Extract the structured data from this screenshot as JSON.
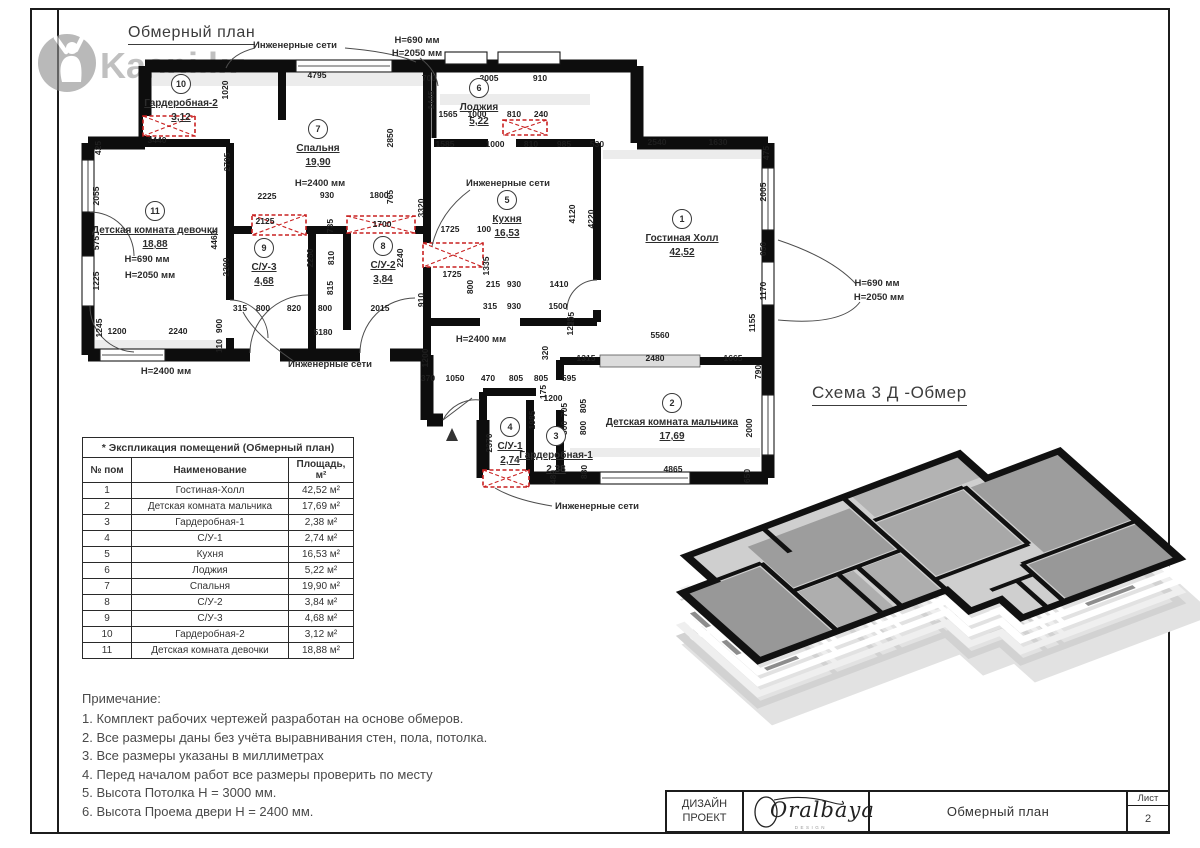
{
  "sheet": {
    "plan_title": "Обмерный план",
    "scheme3d_title": "Схема 3 Д -Обмер",
    "watermark_text": "Kaspi.kz",
    "titleblock": {
      "company_line1": "ДИЗАЙН",
      "company_line2": "ПРОЕКТ",
      "logo_text": "Oralbaya",
      "logo_sub": "DESIGN",
      "doc_title": "Обмерный план",
      "sheet_label": "Лист",
      "sheet_number": "2"
    }
  },
  "explication_table": {
    "title": "* Экспликация помещений (Обмерный план)",
    "headers": [
      "№ пом",
      "Наименование",
      "Площадь, м²"
    ],
    "rows": [
      [
        "1",
        "Гостиная-Холл",
        "42,52 м²"
      ],
      [
        "2",
        "Детская комната мальчика",
        "17,69 м²"
      ],
      [
        "3",
        "Гардеробная-1",
        "2,38 м²"
      ],
      [
        "4",
        "С/У-1",
        "2,74 м²"
      ],
      [
        "5",
        "Кухня",
        "16,53 м²"
      ],
      [
        "6",
        "Лоджия",
        "5,22 м²"
      ],
      [
        "7",
        "Спальня",
        "19,90 м²"
      ],
      [
        "8",
        "С/У-2",
        "3,84 м²"
      ],
      [
        "9",
        "С/У-3",
        "4,68 м²"
      ],
      [
        "10",
        "Гардеробная-2",
        "3,12 м²"
      ],
      [
        "11",
        "Детская комната девочки",
        "18,88 м²"
      ]
    ]
  },
  "notes": {
    "title": "Примечание:",
    "items": [
      "1. Комплект рабочих чертежей разработан на основе обмеров.",
      "2. Все размеры даны без учёта выравнивания стен, пола, потолка.",
      "3. Все размеры указаны в миллиметрах",
      "4. Перед началом работ все размеры проверить по месту",
      "5. Высота Потолка Н = 3000 мм.",
      "6. Высота Проема двери Н = 2400 мм."
    ]
  },
  "plan": {
    "rooms": [
      {
        "num": "1",
        "name": "Гостиная Холл",
        "area": "42,52",
        "x": 682,
        "y": 219
      },
      {
        "num": "2",
        "name": "Детская комната мальчика",
        "area": "17,69",
        "x": 672,
        "y": 403
      },
      {
        "num": "3",
        "name": "Гардеробная-1",
        "area": "2,38",
        "x": 556,
        "y": 436
      },
      {
        "num": "4",
        "name": "С/У-1",
        "area": "2,74",
        "x": 510,
        "y": 427
      },
      {
        "num": "5",
        "name": "Кухня",
        "area": "16,53",
        "x": 507,
        "y": 200
      },
      {
        "num": "6",
        "name": "Лоджия",
        "area": "5,22",
        "x": 479,
        "y": 88
      },
      {
        "num": "7",
        "name": "Спальня",
        "area": "19,90",
        "x": 318,
        "y": 129
      },
      {
        "num": "8",
        "name": "С/У-2",
        "area": "3,84",
        "x": 383,
        "y": 246
      },
      {
        "num": "9",
        "name": "С/У-3",
        "area": "4,68",
        "x": 264,
        "y": 248
      },
      {
        "num": "10",
        "name": "Гардеробная-2",
        "area": "3,12",
        "x": 181,
        "y": 84
      },
      {
        "num": "11",
        "name": "Детская комната девочки",
        "area": "18,88",
        "x": 155,
        "y": 211
      }
    ],
    "annotations": [
      {
        "t": "Инженерные сети",
        "x": 295,
        "y": 48
      },
      {
        "t": "Инженерные сети",
        "x": 508,
        "y": 186
      },
      {
        "t": "Инженерные сети",
        "x": 330,
        "y": 367
      },
      {
        "t": "Инженерные сети",
        "x": 597,
        "y": 509
      },
      {
        "t": "Н=690 мм",
        "x": 417,
        "y": 43
      },
      {
        "t": "Н=2050 мм",
        "x": 417,
        "y": 56
      },
      {
        "t": "Н=690 мм",
        "x": 877,
        "y": 286
      },
      {
        "t": "Н=2050 мм",
        "x": 879,
        "y": 300
      },
      {
        "t": "Н=690 мм",
        "x": 147,
        "y": 262
      },
      {
        "t": "Н=2050 мм",
        "x": 150,
        "y": 278
      },
      {
        "t": "Н=2400 мм",
        "x": 320,
        "y": 186
      },
      {
        "t": "Н=2400 мм",
        "x": 166,
        "y": 374
      },
      {
        "t": "Н=2400 мм",
        "x": 481,
        "y": 342
      }
    ],
    "dims": [
      {
        "t": "4795",
        "x": 317,
        "y": 78
      },
      {
        "t": "700",
        "x": 429,
        "y": 81
      },
      {
        "t": "2005",
        "x": 489,
        "y": 81
      },
      {
        "t": "910",
        "x": 540,
        "y": 81
      },
      {
        "t": "1445",
        "x": 434,
        "y": 100,
        "r": 1
      },
      {
        "t": "1565",
        "x": 448,
        "y": 117
      },
      {
        "t": "1000",
        "x": 477,
        "y": 117
      },
      {
        "t": "810",
        "x": 514,
        "y": 117
      },
      {
        "t": "240",
        "x": 541,
        "y": 117
      },
      {
        "t": "1020",
        "x": 228,
        "y": 90,
        "r": 1
      },
      {
        "t": "3440",
        "x": 157,
        "y": 143
      },
      {
        "t": "425",
        "x": 101,
        "y": 148,
        "r": 1
      },
      {
        "t": "2055",
        "x": 99,
        "y": 196,
        "r": 1
      },
      {
        "t": "575",
        "x": 99,
        "y": 243,
        "r": 1
      },
      {
        "t": "1225",
        "x": 99,
        "y": 281,
        "r": 1
      },
      {
        "t": "1245",
        "x": 102,
        "y": 328,
        "r": 1
      },
      {
        "t": "1200",
        "x": 117,
        "y": 334
      },
      {
        "t": "2240",
        "x": 178,
        "y": 334
      },
      {
        "t": "2705",
        "x": 230,
        "y": 162,
        "r": 1
      },
      {
        "t": "4460",
        "x": 217,
        "y": 240,
        "r": 1
      },
      {
        "t": "2200",
        "x": 229,
        "y": 267,
        "r": 1
      },
      {
        "t": "900",
        "x": 222,
        "y": 326,
        "r": 1
      },
      {
        "t": "110",
        "x": 222,
        "y": 346,
        "r": 1
      },
      {
        "t": "2850",
        "x": 393,
        "y": 138,
        "r": 1
      },
      {
        "t": "2225",
        "x": 267,
        "y": 199
      },
      {
        "t": "930",
        "x": 327,
        "y": 198
      },
      {
        "t": "1800",
        "x": 379,
        "y": 198
      },
      {
        "t": "765",
        "x": 393,
        "y": 197,
        "r": 1
      },
      {
        "t": "3320",
        "x": 424,
        "y": 208,
        "r": 1
      },
      {
        "t": "2125",
        "x": 265,
        "y": 224
      },
      {
        "t": "735",
        "x": 333,
        "y": 226,
        "r": 1
      },
      {
        "t": "1700",
        "x": 382,
        "y": 227
      },
      {
        "t": "2250",
        "x": 313,
        "y": 258,
        "r": 1
      },
      {
        "t": "810",
        "x": 334,
        "y": 258,
        "r": 1
      },
      {
        "t": "2240",
        "x": 403,
        "y": 258,
        "r": 1
      },
      {
        "t": "815",
        "x": 333,
        "y": 288,
        "r": 1
      },
      {
        "t": "315",
        "x": 240,
        "y": 311
      },
      {
        "t": "800",
        "x": 263,
        "y": 311
      },
      {
        "t": "820",
        "x": 294,
        "y": 311
      },
      {
        "t": "800",
        "x": 325,
        "y": 311
      },
      {
        "t": "2015",
        "x": 380,
        "y": 311
      },
      {
        "t": "5180",
        "x": 323,
        "y": 335
      },
      {
        "t": "1200",
        "x": 428,
        "y": 358,
        "r": 1
      },
      {
        "t": "370",
        "x": 428,
        "y": 381
      },
      {
        "t": "1050",
        "x": 455,
        "y": 381
      },
      {
        "t": "470",
        "x": 488,
        "y": 381
      },
      {
        "t": "805",
        "x": 516,
        "y": 381
      },
      {
        "t": "805",
        "x": 541,
        "y": 381
      },
      {
        "t": "595",
        "x": 569,
        "y": 381
      },
      {
        "t": "1585",
        "x": 445,
        "y": 147
      },
      {
        "t": "1000",
        "x": 495,
        "y": 147
      },
      {
        "t": "810",
        "x": 531,
        "y": 147
      },
      {
        "t": "985",
        "x": 564,
        "y": 147
      },
      {
        "t": "530",
        "x": 597,
        "y": 147
      },
      {
        "t": "1725",
        "x": 450,
        "y": 232
      },
      {
        "t": "100",
        "x": 484,
        "y": 232
      },
      {
        "t": "1725",
        "x": 452,
        "y": 277
      },
      {
        "t": "1335",
        "x": 489,
        "y": 266,
        "r": 1
      },
      {
        "t": "800",
        "x": 473,
        "y": 287,
        "r": 1
      },
      {
        "t": "215",
        "x": 493,
        "y": 287
      },
      {
        "t": "930",
        "x": 514,
        "y": 287
      },
      {
        "t": "1410",
        "x": 559,
        "y": 287
      },
      {
        "t": "4120",
        "x": 575,
        "y": 214,
        "r": 1
      },
      {
        "t": "4220",
        "x": 594,
        "y": 219,
        "r": 1
      },
      {
        "t": "315",
        "x": 490,
        "y": 309
      },
      {
        "t": "930",
        "x": 514,
        "y": 309
      },
      {
        "t": "1500",
        "x": 558,
        "y": 309
      },
      {
        "t": "235",
        "x": 574,
        "y": 319,
        "r": 1
      },
      {
        "t": "910",
        "x": 424,
        "y": 300,
        "r": 1
      },
      {
        "t": "2540",
        "x": 657,
        "y": 145
      },
      {
        "t": "1630",
        "x": 718,
        "y": 145
      },
      {
        "t": "475",
        "x": 769,
        "y": 153,
        "r": 1
      },
      {
        "t": "2005",
        "x": 766,
        "y": 192,
        "r": 1
      },
      {
        "t": "650",
        "x": 766,
        "y": 249,
        "r": 1
      },
      {
        "t": "1170",
        "x": 766,
        "y": 291,
        "r": 1
      },
      {
        "t": "1155",
        "x": 755,
        "y": 323,
        "r": 1
      },
      {
        "t": "5560",
        "x": 660,
        "y": 338
      },
      {
        "t": "320",
        "x": 548,
        "y": 353,
        "r": 1
      },
      {
        "t": "1235",
        "x": 573,
        "y": 326,
        "r": 1
      },
      {
        "t": "1315",
        "x": 586,
        "y": 361
      },
      {
        "t": "2480",
        "x": 655,
        "y": 361
      },
      {
        "t": "1665",
        "x": 733,
        "y": 361
      },
      {
        "t": "790",
        "x": 761,
        "y": 372,
        "r": 1
      },
      {
        "t": "2000",
        "x": 752,
        "y": 428,
        "r": 1
      },
      {
        "t": "650",
        "x": 750,
        "y": 476,
        "r": 1
      },
      {
        "t": "4865",
        "x": 673,
        "y": 472
      },
      {
        "t": "880",
        "x": 587,
        "y": 472,
        "r": 1
      },
      {
        "t": "480",
        "x": 556,
        "y": 477,
        "r": 1
      },
      {
        "t": "1985",
        "x": 535,
        "y": 420,
        "r": 1
      },
      {
        "t": "1200",
        "x": 553,
        "y": 401
      },
      {
        "t": "705",
        "x": 567,
        "y": 410,
        "r": 1
      },
      {
        "t": "800",
        "x": 567,
        "y": 428,
        "r": 1
      },
      {
        "t": "805",
        "x": 586,
        "y": 406,
        "r": 1
      },
      {
        "t": "800",
        "x": 586,
        "y": 428,
        "r": 1
      },
      {
        "t": "175",
        "x": 546,
        "y": 392,
        "r": 1
      },
      {
        "t": "2370",
        "x": 492,
        "y": 443,
        "r": 1
      }
    ]
  }
}
